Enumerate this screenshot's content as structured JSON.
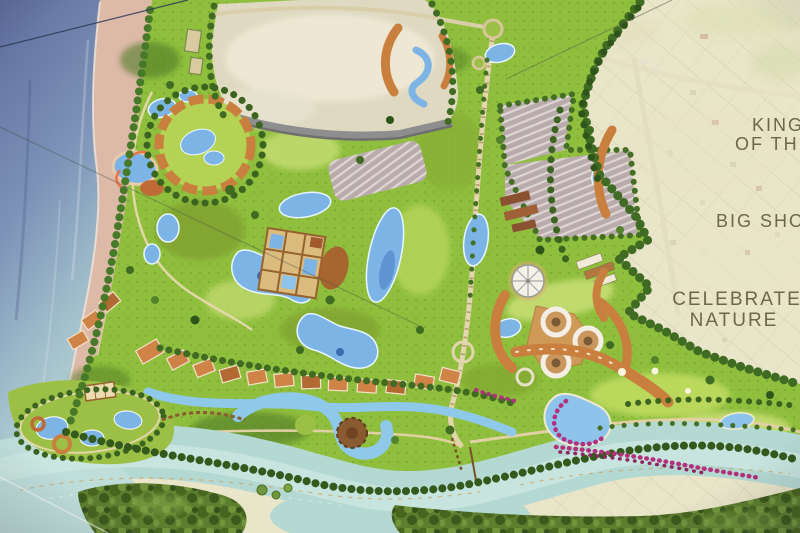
{
  "photo": {
    "subject": "Illustrated theme-park resort master plan photographed on a display board",
    "annotations_language": "English"
  },
  "annotations": {
    "kingdom": {
      "line1": "KINGD",
      "line2": "OF THE"
    },
    "big_show": "BIG SHOW",
    "celebrate": {
      "line1": "CELEBRATE",
      "line2": "NATURE"
    }
  },
  "map_features": [
    {
      "name": "sea",
      "desc": "ocean along the west coast"
    },
    {
      "name": "beach",
      "desc": "pink sand strip"
    },
    {
      "name": "park-grounds",
      "desc": "landscaped resort with lagoons and attractions"
    },
    {
      "name": "development-parcel",
      "desc": "pale cleared site at top"
    },
    {
      "name": "parking-lot",
      "desc": "striped visitor parking"
    },
    {
      "name": "waterpark-cluster",
      "desc": "pool rings in the north-west"
    },
    {
      "name": "courtyard-hotel",
      "desc": "rectangular hotel with water courts"
    },
    {
      "name": "villa-rows",
      "desc": "orange roofed villa blocks"
    },
    {
      "name": "round-towers",
      "desc": "three circular tower buildings"
    },
    {
      "name": "big-top",
      "desc": "radial-roof circular venue"
    },
    {
      "name": "golf-meadows",
      "desc": "fairways lined with flowering trees"
    },
    {
      "name": "river",
      "desc": "wide river across the south"
    },
    {
      "name": "forest",
      "desc": "riparian forest on the south bank"
    },
    {
      "name": "island-resort",
      "desc": "pool island at the river mouth"
    },
    {
      "name": "existing-town",
      "desc": "faded aerial of surrounding town grid"
    }
  ],
  "colors": {
    "sea_deep": "#5e6c9c",
    "sea_mid": "#7d93b8",
    "sea_shallow": "#c2dcd8",
    "beach": "#ddb9a8",
    "park_green": "#90bf3e",
    "lawn": "#c6dd74",
    "tree_dark": "#3f6b22",
    "pool_blue": "#7db4e6",
    "river_teal": "#b4d8d2",
    "roof_orange": "#cd8348",
    "roof_brown": "#8a5230",
    "parking_gray": "#b9abab",
    "parcel_pale": "#ded9c0",
    "faded_context": "#e9e5c9",
    "flower_magenta": "#b3317c",
    "label_text": "#6f654a"
  }
}
